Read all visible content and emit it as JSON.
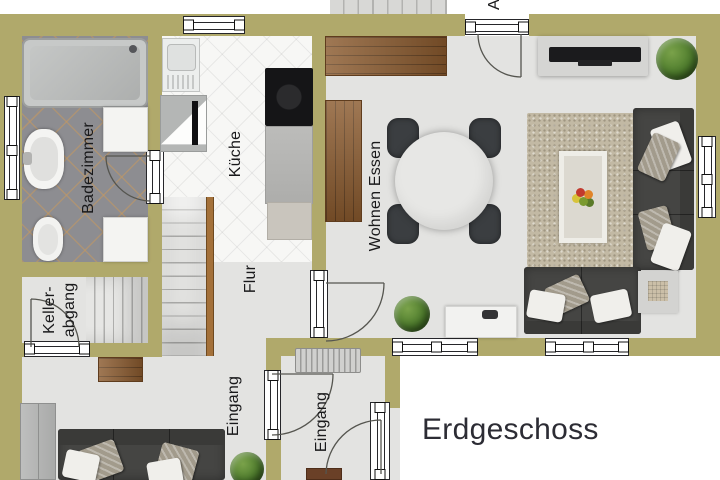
{
  "title": "Erdgeschoss",
  "labels": {
    "badezimmer": "Badezimmer",
    "kueche": "Küche",
    "flur": "Flur",
    "wohnen_essen": "Wohnen Essen",
    "keller_line1": "Keller-",
    "keller_line2": "abgang",
    "eingang_hall": "Eingang",
    "eingang_vestibule": "Eingang",
    "stairs_partial": "Au"
  },
  "colors": {
    "wall": "#b0a96b",
    "floor": "#e3e3e1",
    "bath_tile": "#8d8d91",
    "kitchen_tile": "#f7f7f5",
    "wood": "#8a5a2e",
    "sofa": "#454543",
    "rug": "#c2b9a4",
    "plant_green": "#4d7b2c",
    "title_text": "#2c2c34"
  }
}
